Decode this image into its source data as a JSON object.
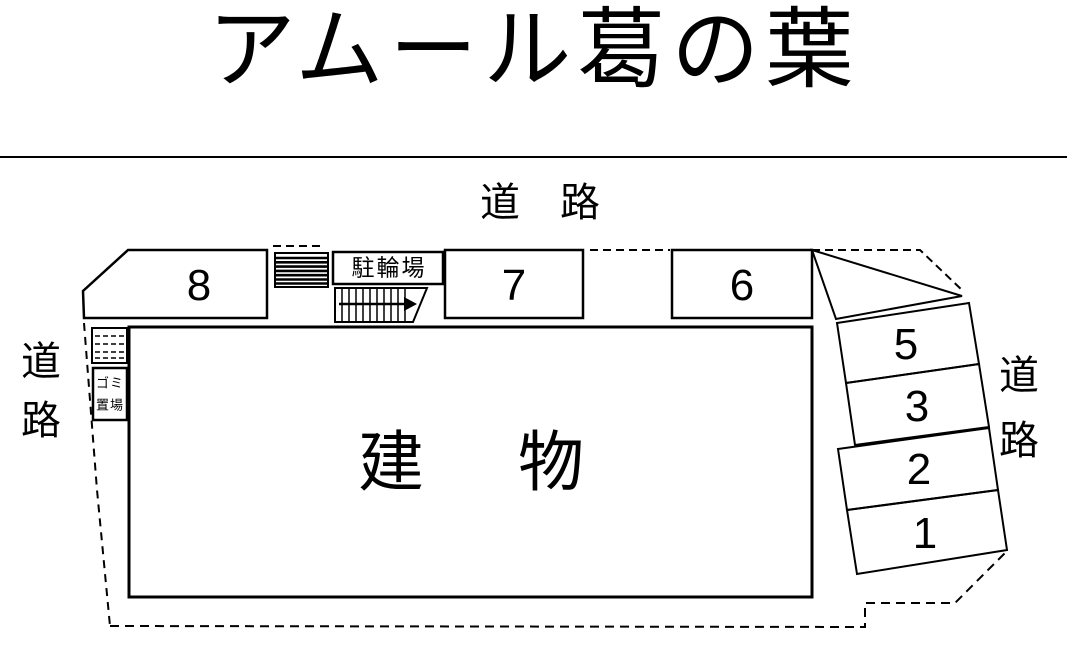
{
  "title": "アムール葛の葉",
  "roads": {
    "top": "道　路",
    "left": {
      "char1": "道",
      "char2": "路"
    },
    "right": {
      "char1": "道",
      "char2": "路"
    }
  },
  "building": {
    "label": "建　物"
  },
  "facilities": {
    "bicycle_parking": "駐輪場",
    "garbage": {
      "line1": "ゴミ",
      "line2": "置場"
    }
  },
  "parking": {
    "space8": "8",
    "space7": "7",
    "space6": "6",
    "space5": "5",
    "space3": "3",
    "space2": "2",
    "space1": "1"
  },
  "colors": {
    "line": "#000000",
    "background": "#ffffff"
  }
}
